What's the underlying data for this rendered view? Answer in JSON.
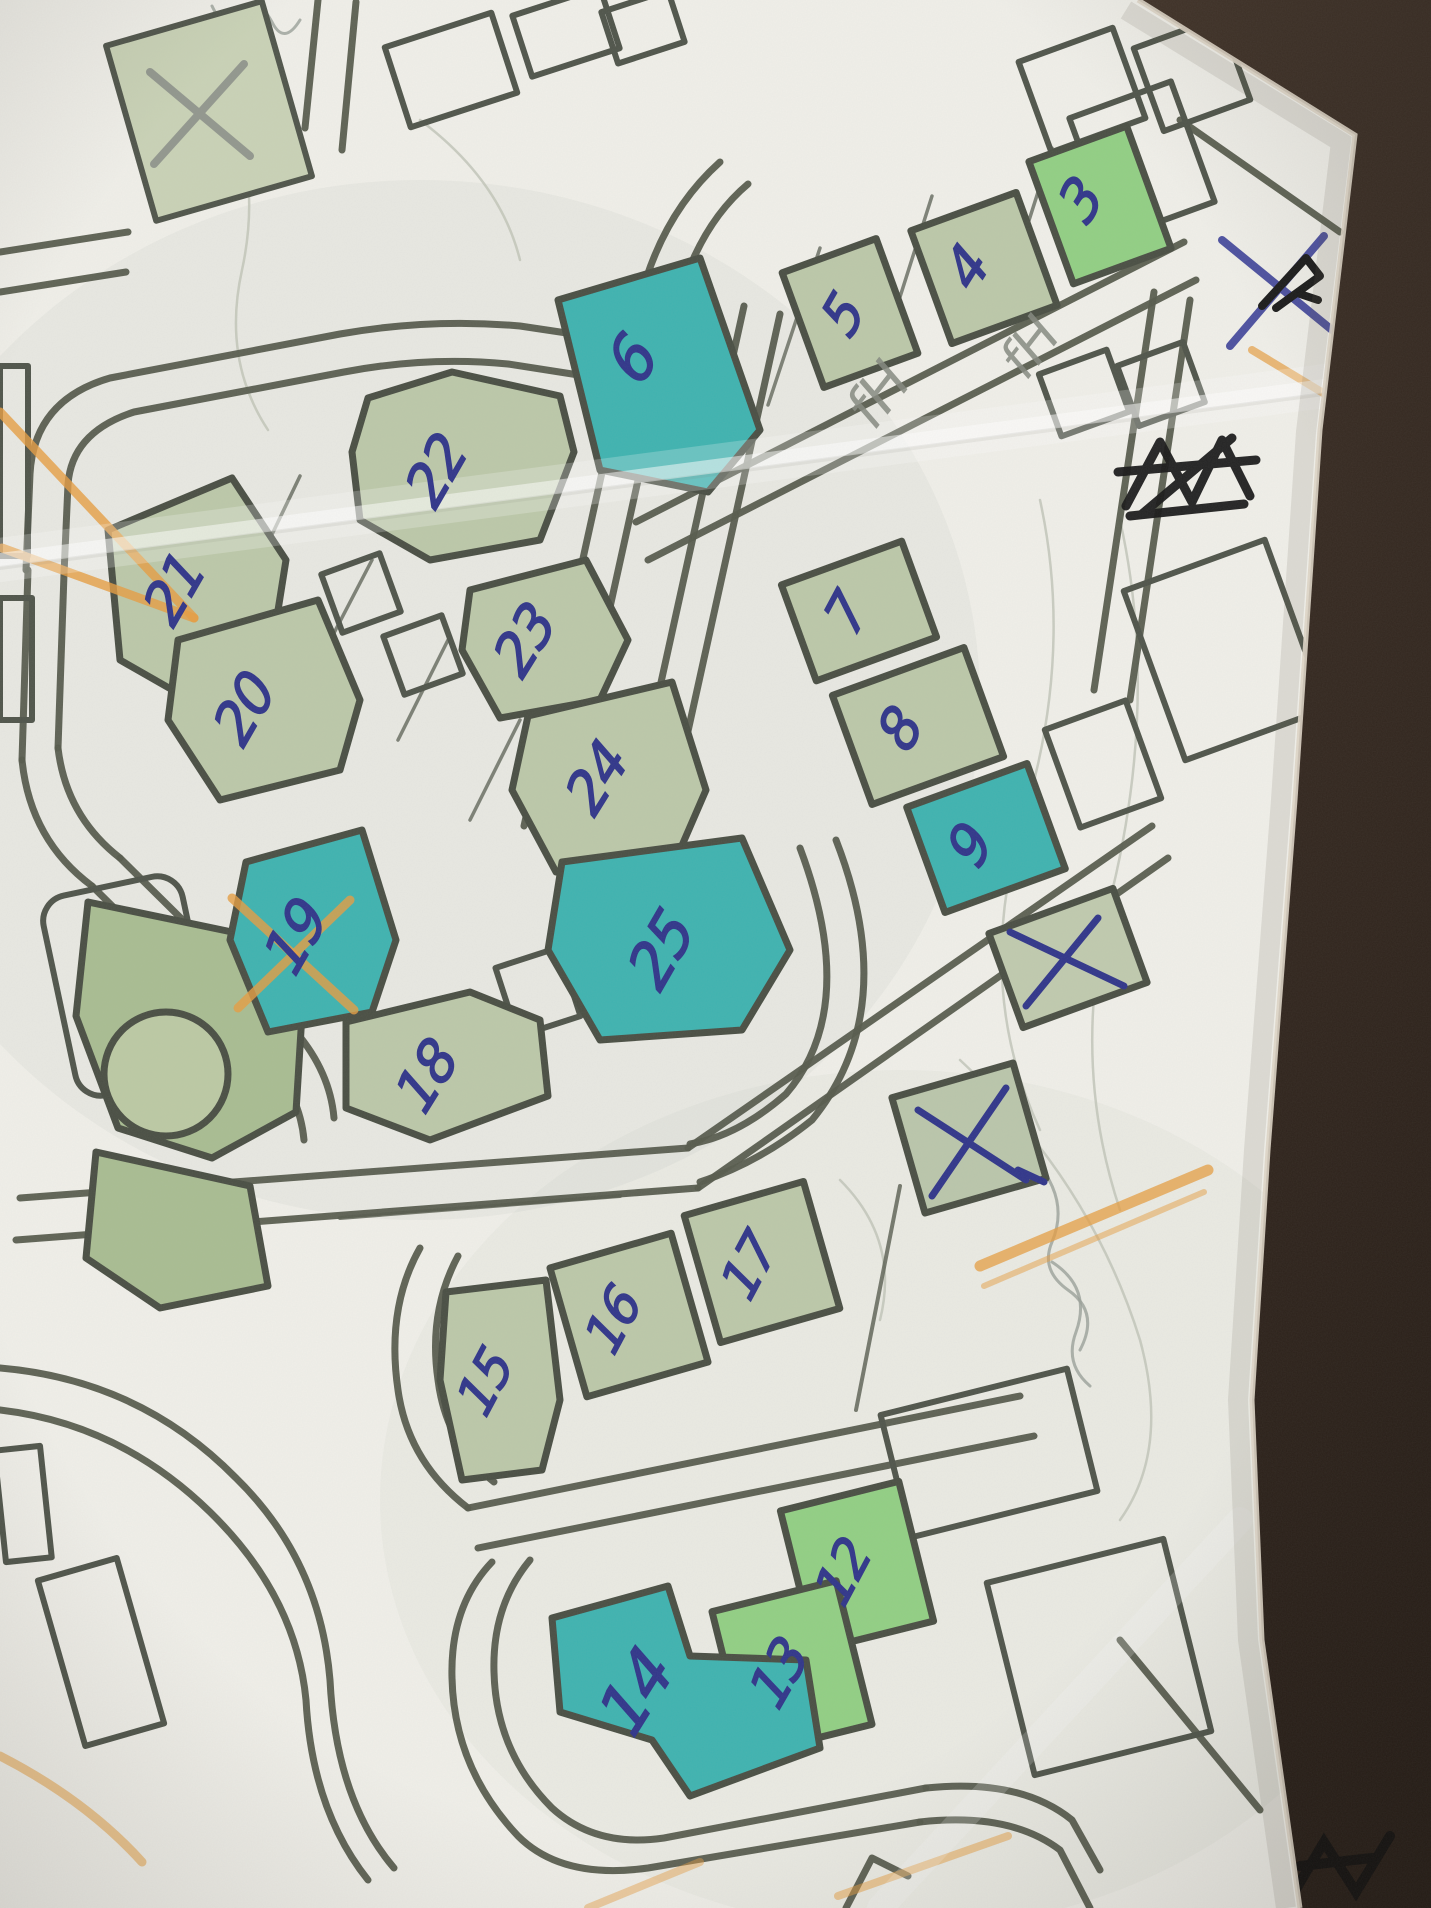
{
  "scene": {
    "description": "Photograph of a printed street map on white paper lying on a dark brown table, hand-annotated with numbered parcels, crossed-out parcels and highlighter lines",
    "table_color": "#3a2d24",
    "paper_color": "#f0efe9"
  },
  "palette": {
    "road_gray": "#565b4d",
    "parcel_green": "#bcc8a9",
    "parcel_bright_green": "#92cf84",
    "highlight_teal": "#3fb3b0",
    "park_green": "#a9bd92",
    "pen_blue": "#31368a",
    "pen_violet": "#4d51a0",
    "pencil_gray": "#8d918a",
    "marker_black": "#1a1a1a",
    "highlighter_orange": "#e69e42"
  },
  "map": {
    "parcels": [
      {
        "id": "p3",
        "label": "3",
        "fill": "bright"
      },
      {
        "id": "p4",
        "label": "4",
        "fill": "green"
      },
      {
        "id": "p5",
        "label": "5",
        "fill": "green"
      },
      {
        "id": "p6",
        "label": "6",
        "fill": "teal"
      },
      {
        "id": "p7",
        "label": "7",
        "fill": "green"
      },
      {
        "id": "p8",
        "label": "8",
        "fill": "green"
      },
      {
        "id": "p9",
        "label": "9",
        "fill": "teal"
      },
      {
        "id": "p12",
        "label": "12",
        "fill": "bright"
      },
      {
        "id": "p13",
        "label": "13",
        "fill": "bright"
      },
      {
        "id": "p14",
        "label": "14",
        "fill": "teal"
      },
      {
        "id": "p15",
        "label": "15",
        "fill": "green"
      },
      {
        "id": "p16",
        "label": "16",
        "fill": "green"
      },
      {
        "id": "p17",
        "label": "17",
        "fill": "green"
      },
      {
        "id": "p18",
        "label": "18",
        "fill": "green"
      },
      {
        "id": "p19",
        "label": "19",
        "fill": "teal"
      },
      {
        "id": "p20",
        "label": "20",
        "fill": "green"
      },
      {
        "id": "p21",
        "label": "21",
        "fill": "green"
      },
      {
        "id": "p22",
        "label": "22",
        "fill": "green"
      },
      {
        "id": "p23",
        "label": "23",
        "fill": "green"
      },
      {
        "id": "p24",
        "label": "24",
        "fill": "green"
      },
      {
        "id": "p25",
        "label": "25",
        "fill": "teal"
      }
    ],
    "crossed_parcels": [
      {
        "id": "x-upper",
        "mark": "X",
        "tool": "pen"
      },
      {
        "id": "x-lower",
        "mark": "X",
        "tool": "pen"
      },
      {
        "id": "x-top-left",
        "mark": "X",
        "tool": "pencil"
      }
    ]
  },
  "annotations": {
    "pen_x_corner": {
      "mark": "X"
    },
    "marker_scribble": {
      "desc": "black marker word scribbled out"
    },
    "pencil_notes": [
      {
        "text": "fH"
      },
      {
        "text": "fH"
      }
    ]
  }
}
